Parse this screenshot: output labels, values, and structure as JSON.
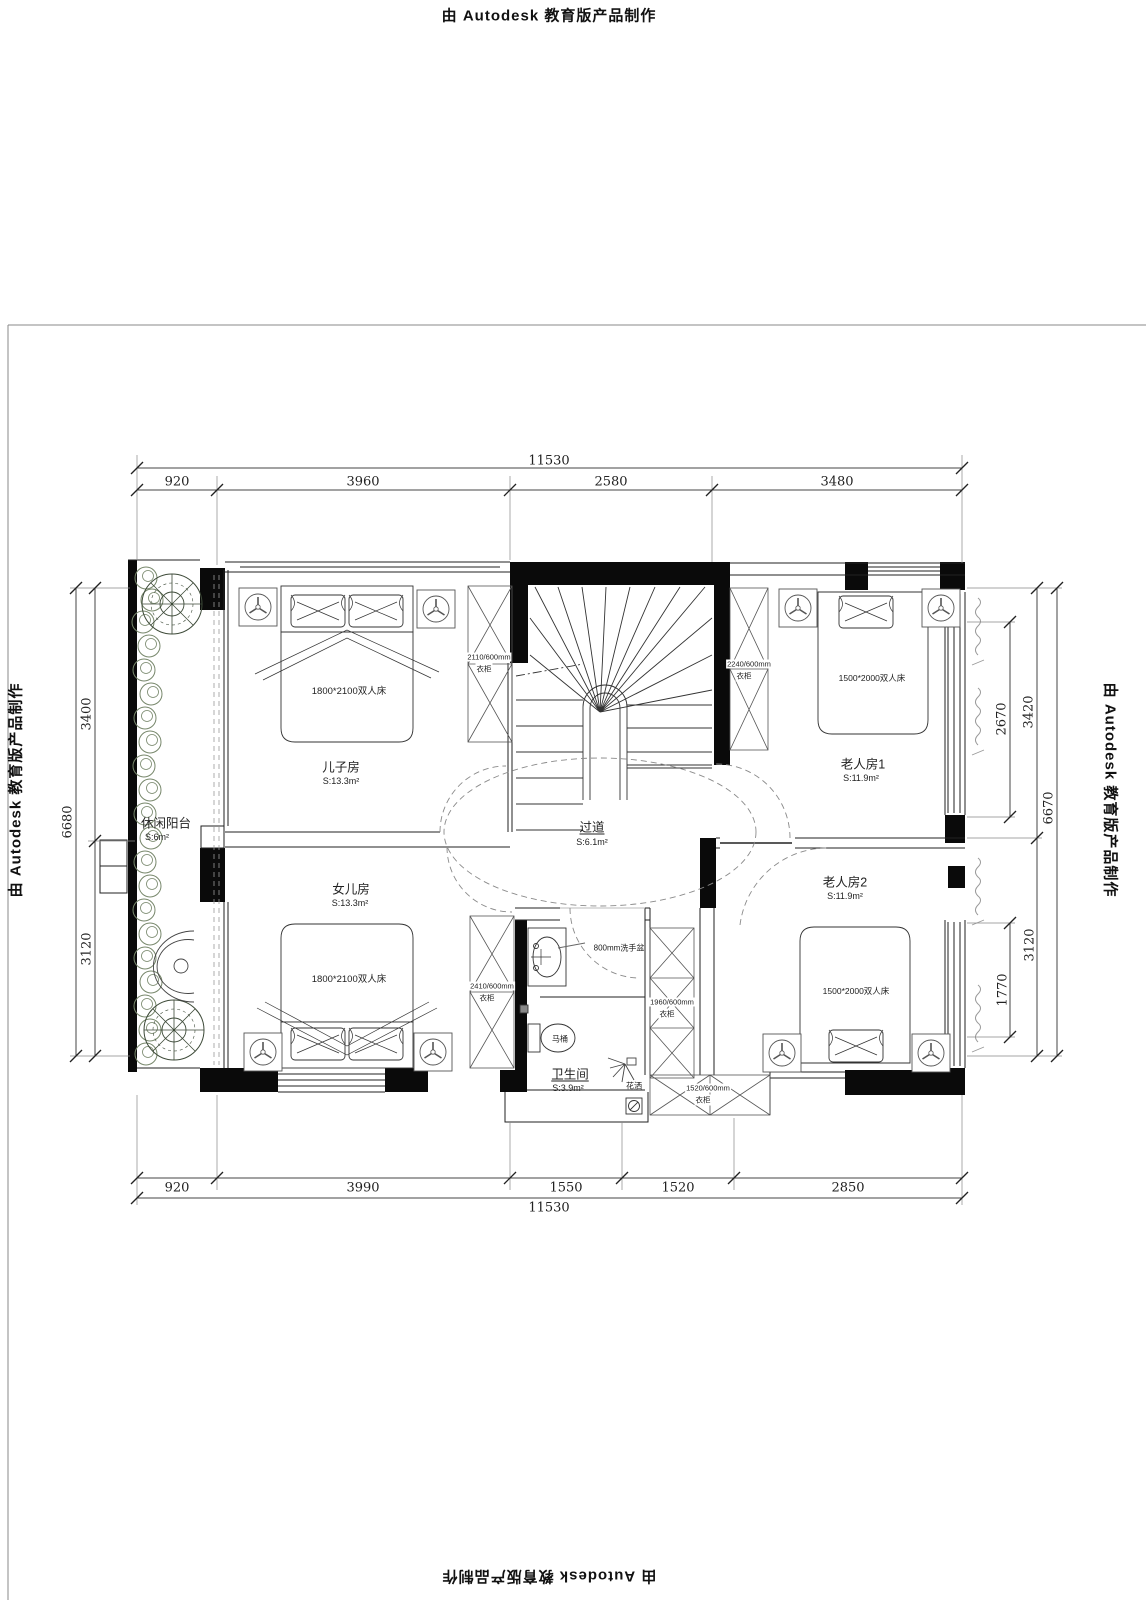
{
  "titles": {
    "autodesk": "由 Autodesk 教育版产品制作"
  },
  "dimensions": {
    "top": {
      "overall": "11530",
      "segments": [
        "920",
        "3960",
        "2580",
        "3480"
      ]
    },
    "bottom": {
      "overall": "11530",
      "segments": [
        "920",
        "3990",
        "1550",
        "1520",
        "2850"
      ]
    },
    "left": {
      "overall": "6680",
      "segments": [
        "3400",
        "3120"
      ]
    },
    "right": {
      "overall": "6670",
      "outer_segments": [
        "3420",
        "3120"
      ],
      "inner_segments": [
        "2670",
        "1770"
      ]
    }
  },
  "rooms": {
    "son": {
      "name": "儿子房",
      "area": "S:13.3m²",
      "bed": "1800*2100双人床",
      "wardrobe_size": "2110/600mm",
      "wardrobe": "衣柜"
    },
    "daughter": {
      "name": "女儿房",
      "area": "S:13.3m²",
      "bed": "1800*2100双人床",
      "wardrobe_size": "2410/600mm",
      "wardrobe": "衣柜"
    },
    "elder1": {
      "name": "老人房1",
      "area": "S:11.9m²",
      "bed": "1500*2000双人床",
      "wardrobe_size": "2240/600mm",
      "wardrobe": "衣柜"
    },
    "elder2": {
      "name": "老人房2",
      "area": "S:11.9m²",
      "bed": "1500*2000双人床"
    },
    "balcony": {
      "name": "休闲阳台",
      "area": "S:6m²"
    },
    "corridor": {
      "name": "过道",
      "area": "S:6.1m²"
    },
    "bathroom": {
      "name": "卫生间",
      "area": "S:3.9m²",
      "basin": "800mm洗手盆",
      "toilet": "马桶",
      "shower": "花洒"
    }
  },
  "cabinets": {
    "hall": {
      "size": "1960/600mm",
      "label": "衣柜"
    },
    "entry": {
      "size": "1520/600mm",
      "label": "衣柜"
    }
  }
}
